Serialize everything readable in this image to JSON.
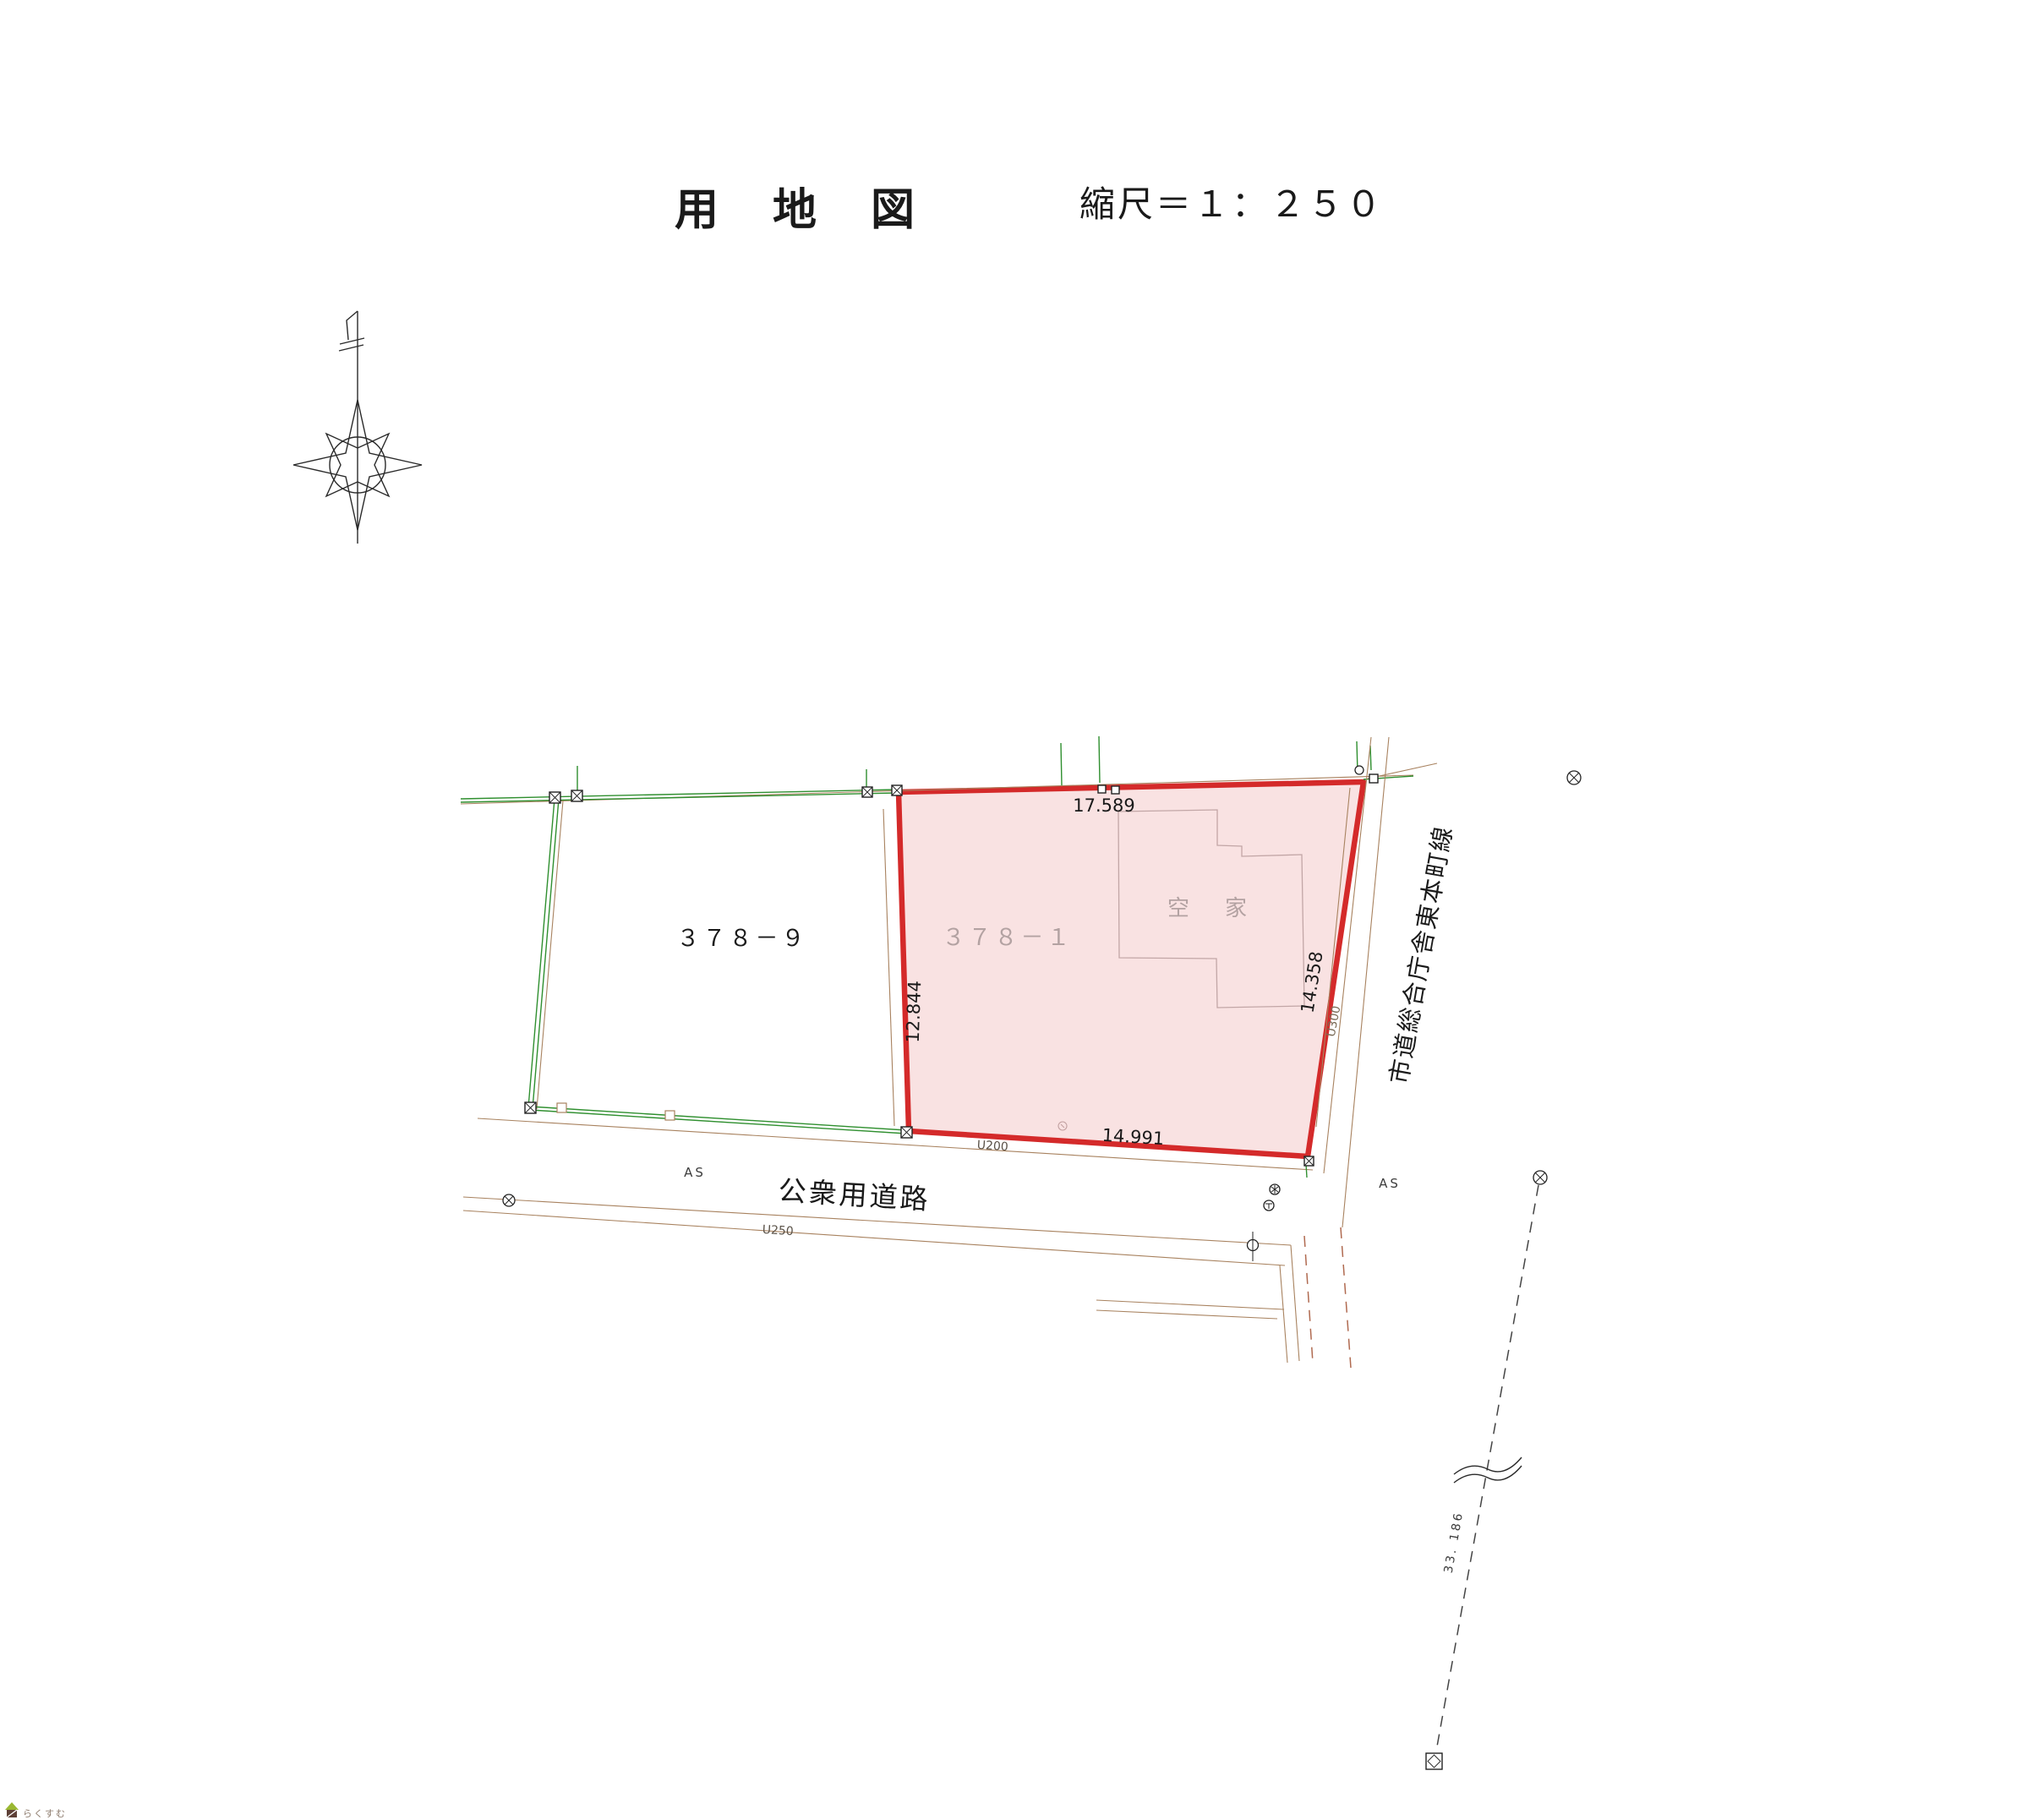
{
  "title": {
    "main": "用　地　図",
    "scale": "縮尺＝１：２５０"
  },
  "parcels": {
    "left": {
      "number": "３７８－９"
    },
    "subject": {
      "number": "３７８－１",
      "building_label": "空　家"
    }
  },
  "dimensions": {
    "top": "17.589",
    "left": "12.844",
    "right": "14.358",
    "bottom": "14.991"
  },
  "roads": {
    "south": {
      "name": "公衆用道路",
      "surface": "AS",
      "gutter": "U250"
    },
    "east": {
      "name": "市道総合庁舎東本町線",
      "surface": "AS",
      "gutter": "U300"
    },
    "frontage_gutter": "U200"
  },
  "survey": {
    "distance": "33. 186"
  },
  "logo": {
    "text": "らくすむ"
  },
  "colors": {
    "boundary_red": "#d42a2a",
    "parcel_fill": "#f9e2e2",
    "fence_green": "#2f8f2f",
    "road_brown": "#a8825f",
    "building_gray": "#c2a6a6"
  }
}
